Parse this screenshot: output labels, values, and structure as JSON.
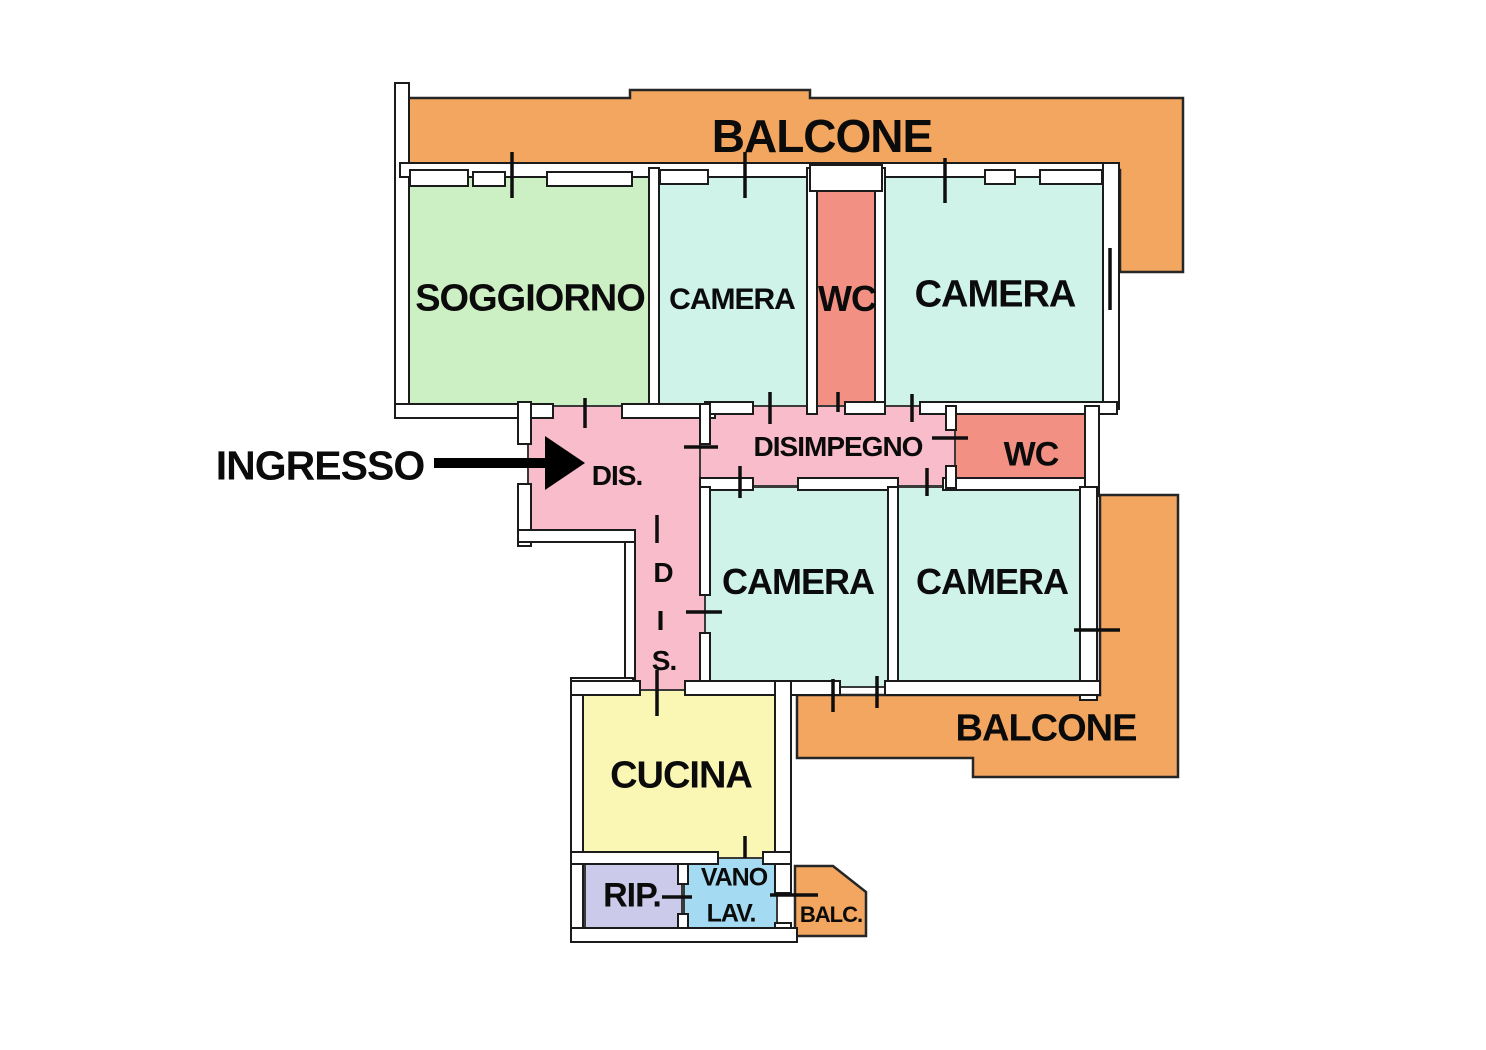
{
  "plan": {
    "balcony_top_label": "BALCONE",
    "soggiorno_label": "SOGGIORNO",
    "camera_top_left_label": "CAMERA",
    "wc_top_label": "WC",
    "camera_top_right_label": "CAMERA",
    "ingresso_label": "INGRESSO",
    "dis_label": "DIS.",
    "disimpegno_label": "DISIMPEGNO",
    "wc_mid_label": "WC",
    "dis_vertical": [
      "D",
      "I",
      "S."
    ],
    "camera_mid_left_label": "CAMERA",
    "camera_mid_right_label": "CAMERA",
    "balcony_right_label": "BALCONE",
    "cucina_label": "CUCINA",
    "rip_label": "RIP.",
    "vano_lav_lines": [
      "VANO",
      "LAV."
    ],
    "balc_small_label": "BALC."
  },
  "colors": {
    "balcony": "#F3A660",
    "soggiorno": "#CDEFC4",
    "camera": "#CFF2E9",
    "wc": "#F19083",
    "corridor_pink": "#F8BCCB",
    "cucina": "#FAF6B3",
    "rip": "#CBCAEB",
    "vano_lav": "#A5DBF2",
    "ink": "#0e0e0e"
  }
}
